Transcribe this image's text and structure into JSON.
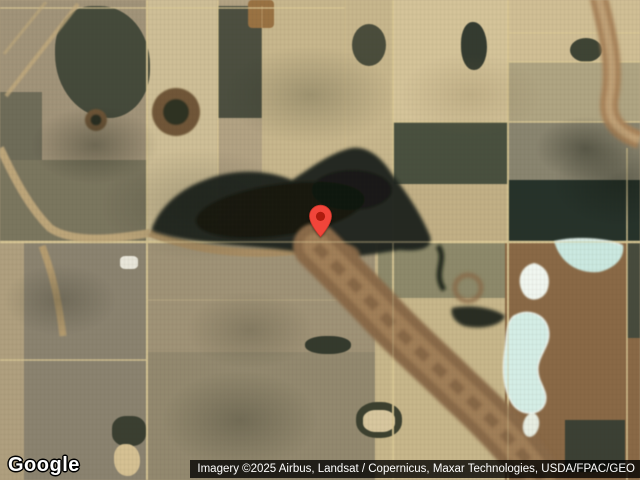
{
  "map": {
    "view": "satellite",
    "logo": {
      "text": "Google"
    },
    "attribution": {
      "text": "Imagery ©2025 Airbus, Landsat / Copernicus, Maxar Technologies, USDA/FPAC/GEO"
    },
    "marker": {
      "name": "location-pin",
      "x": 320,
      "y": 238,
      "color": "#F1453A",
      "dot_color": "#AD1B0E"
    },
    "palette": {
      "field_light_tan": "#d5c49a",
      "field_tan": "#c8b78d",
      "field_gray_brown": "#8b8370",
      "field_dark_olive": "#49503f",
      "field_darkest_green": "#26322a",
      "wetland_dark": "#1c231b",
      "valley_brown": "#8a6a48",
      "lake_cyan": "#cbe9e1",
      "pond_white": "#f1f7f0",
      "road_tan": "#dcca97"
    }
  }
}
